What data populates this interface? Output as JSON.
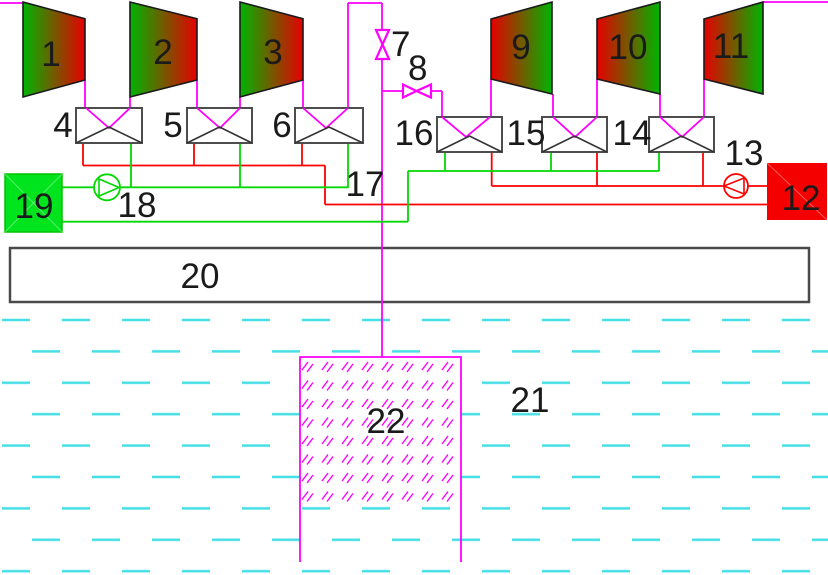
{
  "schematic": {
    "description": "geothermal power plant process flow diagram with turbine trains, condensers/heat exchangers, valves, pumps, surface unit and injection well in groundwater",
    "labels": {
      "turbine_1": "1",
      "turbine_2": "2",
      "turbine_3": "3",
      "hx_4": "4",
      "hx_5": "5",
      "hx_6": "6",
      "valve_7": "7",
      "valve_8": "8",
      "turbine_9": "9",
      "turbine_10": "10",
      "turbine_11": "11",
      "hot_tank_12": "12",
      "pump_13": "13",
      "hx_14": "14",
      "hx_15": "15",
      "hx_16": "16",
      "junction_17": "17",
      "pump_18": "18",
      "cold_tank_19": "19",
      "surface_unit_20": "20",
      "ground_21": "21",
      "well_22": "22"
    },
    "colors": {
      "steam_line": "#ff00ff",
      "hot_line": "#ff0000",
      "cold_line": "#00d800",
      "water_dash": "#45dfe6",
      "turbine_gradient_green": "#00b400",
      "turbine_gradient_red": "#e60000",
      "hot_tank_fill": "#f50000",
      "cold_tank_fill": "#00e41e",
      "box_outline": "#4d4d4d",
      "label_text": "#1a1a1a",
      "well_hatch": "#ff00ff"
    }
  }
}
